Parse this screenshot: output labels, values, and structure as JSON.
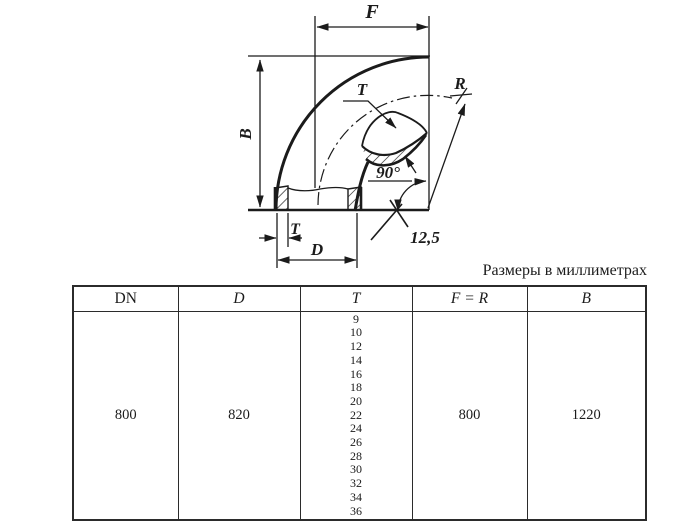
{
  "caption": "Размеры в миллиметрах",
  "drawing": {
    "labels": {
      "f": "F",
      "r": "R",
      "b": "B",
      "t_top": "T",
      "angle": "90°",
      "roughness": "12,5",
      "t_bottom": "T",
      "d": "D"
    }
  },
  "table": {
    "headers": [
      "DN",
      "D",
      "T",
      "F = R",
      "B"
    ],
    "row": {
      "dn": "800",
      "d": "820",
      "t_values": [
        "9",
        "10",
        "12",
        "14",
        "16",
        "18",
        "20",
        "22",
        "24",
        "26",
        "28",
        "30",
        "32",
        "34",
        "36"
      ],
      "f_r": "800",
      "b": "1220"
    }
  },
  "colors": {
    "ink": "#1b1b1b",
    "background": "#ffffff"
  }
}
